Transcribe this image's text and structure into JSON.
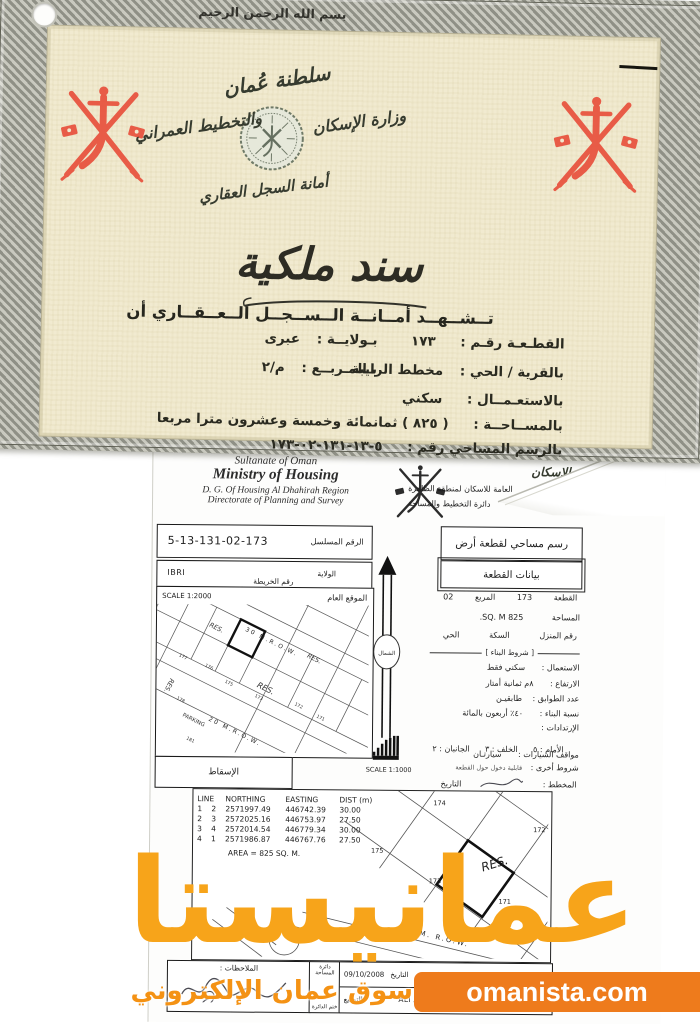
{
  "brand": {
    "watermark": "عمانيستا",
    "domain": "omanista.com",
    "tagline": "سوق عمان الإلكتروني"
  },
  "colors": {
    "emblem_red": "#e8503c",
    "watermark_orange": "#f7a41a",
    "banner_orange": "#ee7b1c",
    "certificate_paper": "#f1ead0"
  },
  "certificate": {
    "basmala": "بسم الله الرحمن الرحيم",
    "sultanate": "سلطنة عُمان",
    "ministry_right": "وزارة الإسكان",
    "ministry_left": "والتخطيط العمراني",
    "registry": "أمانة السجل العقاري",
    "title": "سند ملكية",
    "attest": "تــشــهــد أمــانــة الــســجــل الــعــقــاري أن",
    "plot_label": "القطـعـة رقـم :",
    "plot_value": "١٧٣",
    "wilaya_label": "بـولايــة :",
    "wilaya_value": "عبرى",
    "village_label": "بالقرية / الحي :",
    "village_value": "مخطط الرايبة",
    "square_label": "بـالمـربــع :",
    "square_value": "م/٢",
    "use_label": "بالاستعـمــال :",
    "use_value": "سكني",
    "area_label": "بالمســاحــة :",
    "area_value": "( ٨٢٥ ) ثمانمائة وخمسة وعشرون مترا مربعا",
    "survey_label": "بالرسم المساحي رقم :",
    "survey_value": "١٧٣-٠٢-١٣١-١٣-٥"
  },
  "survey": {
    "header": {
      "en_line1": "Sultanate of Oman",
      "en_line2": "Ministry of Housing",
      "en_line3": "D. G. Of Housing  Al Dhahirah Region",
      "en_line4": "Directorate of Planning and Survey",
      "ar_callig1": "سلطنة عُمان",
      "ar_callig2": "وزارة الإسكان",
      "ar_line1": "العامة للاسكان لمنطقة الظاهرة",
      "ar_line2": "دائرة التخطيط والمساحة"
    },
    "boxes": {
      "serial_label": "الرقم المسلسل",
      "serial": "5-13-131-02-173",
      "title": "رسم مساحي لقطعة أرض",
      "map_no_label": "رقم الخريطة",
      "wilaya_label": "الولاية",
      "wilaya": "IBRI",
      "town_label": "المدينة / القرية",
      "town": "ALRAYBAH",
      "data_title": "بيانات القطعة",
      "location_label": "الموقع العام",
      "scale1": "SCALE 1:2000",
      "scale2": "SCALE 1:1000",
      "north": "الشمال",
      "projection": "الإسقاط"
    },
    "plot_data": {
      "plot_l": "القطعة",
      "plot": "173",
      "square_l": "المربع",
      "square": "02",
      "area_l": "المساحة",
      "area": "825 SQ. M.",
      "house_l": "رقم المنزل",
      "street_l": "السكة",
      "district_l": "الحي",
      "conditions": "[ شروط البناء ]",
      "use_l": "الاستعمال :",
      "use": "سكني فقط",
      "height_l": "الارتفاع :",
      "height": "٨م ثمانية أمتار",
      "floors_l": "عدد الطوابق :",
      "floors": "طابقيـن",
      "ratio_l": "نسبة البناء :",
      "ratio": "٤٠٪ أربعون بالمائة",
      "setbacks_l": "الإرتدادات :",
      "setbacks": "الأمام : ٥      الخلف : ٣      الجانبان : ٢",
      "parking_l": "مواقف السيارات :",
      "parking": "سيارتـان",
      "other_l": "شروط أخرى :",
      "other": "قابلية دخول حول القطعة",
      "planner_l": "المخطط :",
      "date_l": "التاريخ"
    },
    "coords": {
      "h_line": "LINE",
      "h_north": "NORTHING",
      "h_east": "EASTING",
      "h_dist": "DIST (m)",
      "rows": [
        [
          "1",
          "2",
          "2571997.49",
          "446742.39",
          "30.00"
        ],
        [
          "2",
          "3",
          "2572025.16",
          "446753.97",
          "27.50"
        ],
        [
          "3",
          "4",
          "2572014.54",
          "446779.34",
          "30.00"
        ],
        [
          "4",
          "1",
          "2571986.87",
          "446767.76",
          "27.50"
        ]
      ],
      "area_note": "AREA = 825 SQ. M."
    },
    "site_plan": {
      "road1": "30 M.R.O.W.",
      "road2": "20 M.R.O.W.",
      "parking": "PARKING",
      "res": "RES.",
      "nums": [
        "177",
        "176",
        "175",
        "173",
        "172",
        "178",
        "171",
        "181"
      ]
    },
    "detail_plan": {
      "res": "RES.",
      "road": "20 M. R.O.W.",
      "plots": [
        "174",
        "175",
        "173",
        "172",
        "171"
      ]
    },
    "footer": {
      "notes_label": "الملاحظات :",
      "dept_top": "دائرة المساحة",
      "dept_bottom": "ختم الدائرة",
      "surveyor_l": "المساح",
      "surveyor": "MASHHOOR",
      "numbering_l": "الترقيم",
      "date_l": "التاريخ",
      "date": "09/10/2008",
      "manager_l": "المدير",
      "manager": "ALI ABDULLAH AL HINAI",
      "sign_l": "التوقيع"
    }
  }
}
